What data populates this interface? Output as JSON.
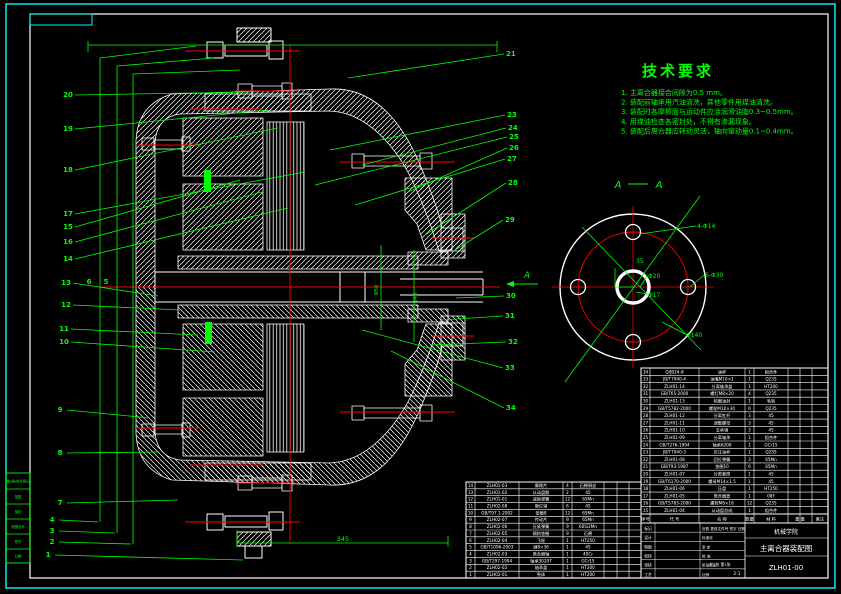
{
  "colors": {
    "background": "#000000",
    "line": "#ffffff",
    "leader": "#00ff00",
    "centerline": "#ff0000",
    "border": "#00ffff"
  },
  "margin_table": {
    "rows": [
      "借(通)用件登记",
      "描图",
      "描校",
      "底图总号",
      "签字",
      "日期"
    ]
  },
  "tech_requirements": {
    "title": "技术要求",
    "lines": [
      "1. 主离合器接合间隙为0.5 mm。",
      "2. 装配前轴承用汽油清洗，其他零件用煤油清洗。",
      "3. 装配时各摩擦面与运动件应涂润滑油脂0.3~0.5mm。",
      "4. 用煤油检查各密封处，不得有渗漏现象。",
      "5. 装配后离合器应转动灵活，轴向窜动量0.1~0.4mm。"
    ]
  },
  "section_view": {
    "label_left": "A",
    "label_right": "A",
    "cut_arrow_label": "A"
  },
  "right_view": {
    "labels": [
      "4-Φ14",
      "35",
      "Φ20",
      "Φ17",
      "6-Φ30",
      "Φ140"
    ]
  },
  "dimensions": {
    "bottom_length": "345",
    "shaft_dim_1": "Φ50",
    "shaft_dim_2": "Φ40"
  },
  "balloons": {
    "left": [
      "20",
      "19",
      "18",
      "17",
      "15",
      "16",
      "14",
      "13",
      "12",
      "11",
      "10"
    ],
    "lower_left": [
      "9",
      "8",
      "7",
      "4",
      "3",
      "2",
      "1"
    ],
    "trunk": [
      "6",
      "5"
    ],
    "right": [
      "21",
      "23",
      "24",
      "25",
      "26",
      "27",
      "28",
      "29",
      "30",
      "31",
      "32",
      "33",
      "34"
    ]
  },
  "bom_right": {
    "header": [
      "序号",
      "代  号",
      "名  称",
      "数量",
      "材  料",
      "重  量",
      "备注"
    ],
    "rows": [
      [
        "34",
        "Q/JB24-8",
        "油杯",
        "1",
        "组合件"
      ],
      [
        "33",
        "JB/T7940-4",
        "油嘴M10×1",
        "1",
        "Q235"
      ],
      [
        "32",
        "ZLH01-14",
        "分离轴承盖",
        "1",
        "HT200"
      ],
      [
        "31",
        "GB/T65-2000",
        "螺钉M8×20",
        "4",
        "Q235"
      ],
      [
        "30",
        "ZLH01-13",
        "毡圈油封",
        "1",
        "毛毡"
      ],
      [
        "29",
        "GB/T5782-2000",
        "螺栓M10×30",
        "6",
        "Q235"
      ],
      [
        "28",
        "ZLH01-12",
        "分离杠杆",
        "3",
        "45"
      ],
      [
        "27",
        "ZLH01-11",
        "调整螺母",
        "3",
        "45"
      ],
      [
        "26",
        "ZLH01-10",
        "支承销",
        "3",
        "45"
      ],
      [
        "25",
        "ZLH01-09",
        "分离轴承",
        "1",
        "组合件"
      ],
      [
        "24",
        "GB/T276-1994",
        "轴承6208",
        "1",
        "GCr15"
      ],
      [
        "23",
        "JB/T7940-3",
        "压注油杯",
        "1",
        "Q235"
      ],
      [
        "22",
        "ZLH01-08",
        "回位弹簧",
        "3",
        "65Mn"
      ],
      [
        "21",
        "GB/T93-1987",
        "垫圈10",
        "6",
        "65Mn"
      ],
      [
        "20",
        "ZLH01-07",
        "分离套筒",
        "1",
        "45"
      ],
      [
        "19",
        "GB/T6170-2000",
        "螺母M14×1.5",
        "1",
        "45"
      ],
      [
        "18",
        "ZLH01-06",
        "压盘",
        "1",
        "HT250"
      ],
      [
        "17",
        "ZLH01-05",
        "离合器盖",
        "1",
        "08F"
      ],
      [
        "16",
        "GB/T5783-2000",
        "螺栓M8×16",
        "12",
        "Q235"
      ],
      [
        "15",
        "ZLH01-04",
        "从动盘总成",
        "1",
        "组合件"
      ]
    ]
  },
  "bom_left": {
    "rows": [
      [
        "14",
        "ZLH01-03",
        "摩擦片",
        "4",
        "石棉铜丝"
      ],
      [
        "13",
        "ZLH01-02",
        "从动盘毂",
        "2",
        "45"
      ],
      [
        "12",
        "ZLH01-01",
        "减振弹簧",
        "12",
        "65Mn"
      ],
      [
        "11",
        "ZLH02-08",
        "限位销",
        "6",
        "45"
      ],
      [
        "10",
        "GB/T97.1-2002",
        "垫圈8",
        "12",
        "65Mn"
      ],
      [
        "9",
        "ZLH02-07",
        "传动片",
        "9",
        "65Mn"
      ],
      [
        "8",
        "ZLH02-06",
        "压紧弹簧",
        "9",
        "60Si2Mn"
      ],
      [
        "7",
        "ZLH02-05",
        "隔热垫圈",
        "9",
        "石棉"
      ],
      [
        "6",
        "ZLH02-04",
        "飞轮",
        "1",
        "HT250"
      ],
      [
        "5",
        "GB/T1096-2003",
        "键8×36",
        "1",
        "45"
      ],
      [
        "4",
        "ZLH02-03",
        "离合器轴",
        "1",
        "40Cr"
      ],
      [
        "3",
        "GB/T297-1994",
        "轴承30207",
        "1",
        "GCr15"
      ],
      [
        "2",
        "ZLH02-02",
        "轴承盖",
        "1",
        "HT200"
      ],
      [
        "1",
        "ZLH02-01",
        "壳体",
        "1",
        "HT200"
      ]
    ]
  },
  "title_block": {
    "unit": "机械学院",
    "title": "主离合器装配图",
    "drawing_no": "ZLH01-00",
    "row_labels": [
      "标记",
      "设计",
      "制图",
      "校核",
      "审核",
      "工艺"
    ],
    "row_labels2": [
      "处数 更改文件号 签字 日期",
      "标准化",
      "审 定",
      "批 准",
      "阶段标记",
      "比例"
    ],
    "scale": "2:1",
    "sheet": "共1张 第1张"
  }
}
